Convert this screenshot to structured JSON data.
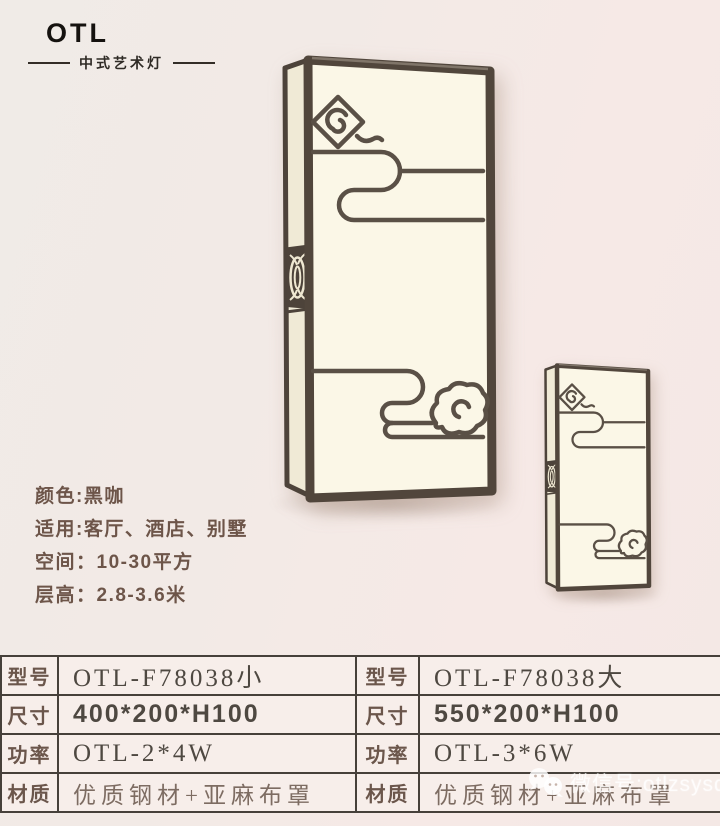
{
  "logo": {
    "brand": "OTL",
    "tagline": "中式艺术灯"
  },
  "info": {
    "color": "颜色:黑咖",
    "usage": "适用:客厅、酒店、别墅",
    "space": "空间：10-30平方",
    "ceiling_height": "层高：2.8-3.6米"
  },
  "spec_table": {
    "rows": [
      {
        "label": "型号",
        "left": "OTL-F78038小",
        "right": "OTL-F78038大"
      },
      {
        "label": "尺寸",
        "left": "400*200*H100",
        "right": "550*200*H100"
      },
      {
        "label": "功率",
        "left": "OTL-2*4W",
        "right": "OTL-3*6W"
      },
      {
        "label": "材质",
        "left": "优质钢材+亚麻布罩",
        "right": "优质钢材+亚麻布罩"
      }
    ]
  },
  "watermark": {
    "wechat_id": "微信号:otlzsysd"
  },
  "colors": {
    "background_left": "#f0ebe7",
    "background_right": "#f6e9e6",
    "lamp_frame": "#51463c",
    "lamp_shade": "#fbf7e7",
    "cloud_line": "#5a5046",
    "table_border": "#46403a",
    "label_text": "#6b564b",
    "value_text": "#4e4841",
    "logo_text": "#15120f"
  }
}
